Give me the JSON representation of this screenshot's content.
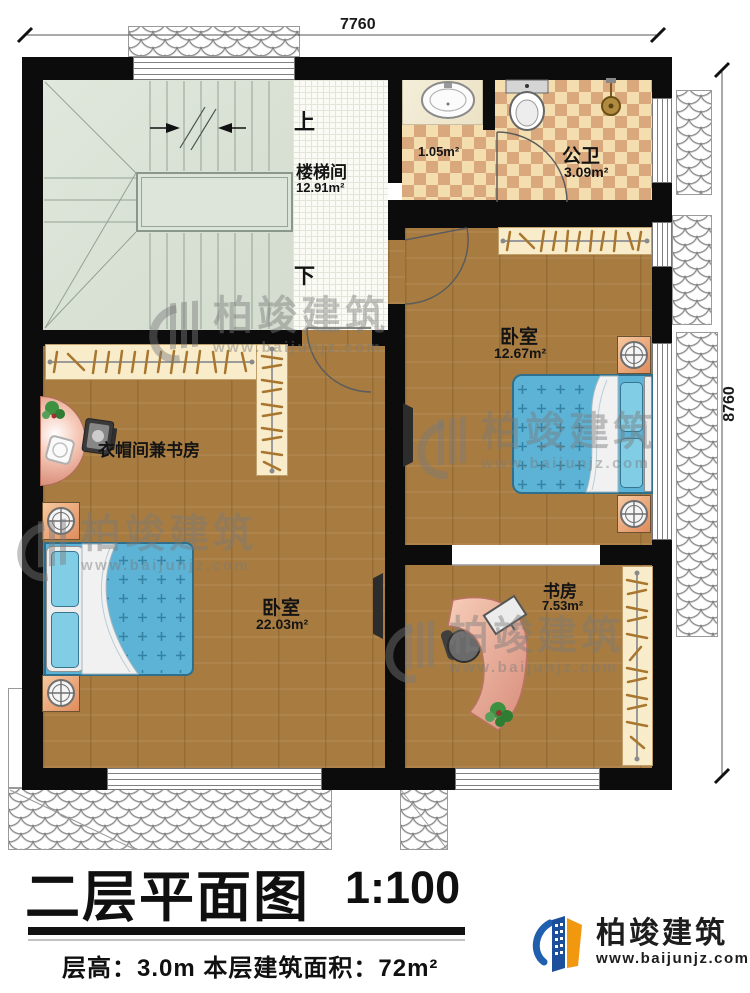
{
  "dimensions": {
    "top": "7760",
    "right": "8760"
  },
  "stairs": {
    "up": "上",
    "down": "下"
  },
  "rooms": {
    "stairwell": {
      "name": "楼梯间",
      "area": "12.91m²"
    },
    "bath_lobby": {
      "area": "1.05m²"
    },
    "bathroom": {
      "name": "公卫",
      "area": "3.09m²"
    },
    "bedroom_right": {
      "name": "卧室",
      "area": "12.67m²"
    },
    "cloak_study": {
      "name": "衣帽间兼书房"
    },
    "bedroom_left": {
      "name": "卧室",
      "area": "22.03m²"
    },
    "study": {
      "name": "书房",
      "area": "7.53m²"
    }
  },
  "watermark": {
    "brand": "柏竣建筑",
    "url": "www.baijunjz.com"
  },
  "title_block": {
    "title": "二层平面图",
    "scale": "1:100",
    "specs": "层高：3.0m  本层建筑面积：72m²"
  },
  "logo": {
    "brand": "柏竣建筑",
    "url": "www.baijunjz.com"
  },
  "colors": {
    "wall": "#0c0c0c",
    "wood_floor": "#a87c41",
    "stair_floor": "#dde4d9",
    "tile_light": "#f4deb0",
    "tile_dark": "#d9a87c",
    "bed": "#5cb3d6",
    "wardrobe": "#f8ecca",
    "logo_blue": "#1f5fae",
    "logo_orange": "#f2980f"
  }
}
